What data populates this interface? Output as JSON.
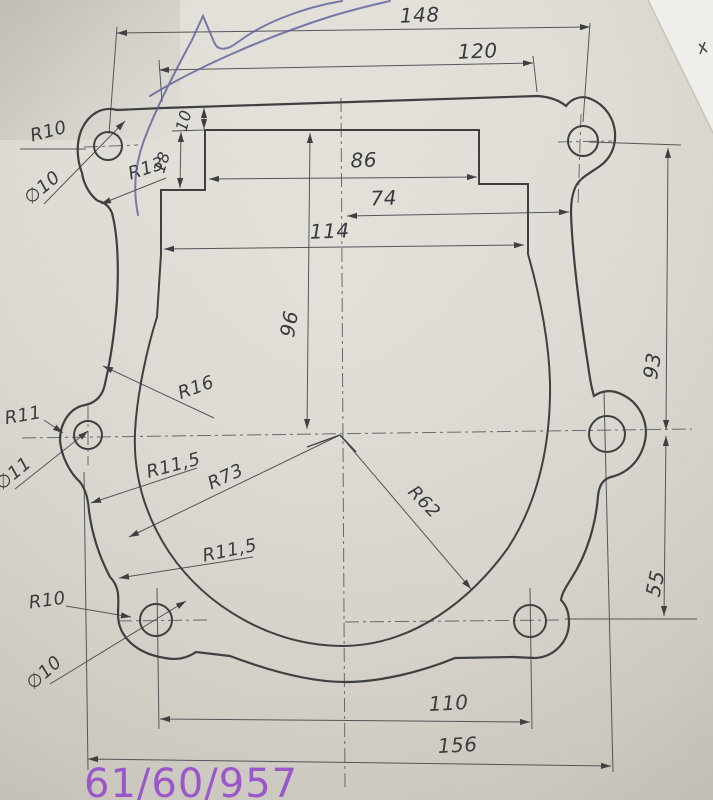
{
  "drawing": {
    "dims": {
      "top_hole_span": "148",
      "flange_width": "120",
      "step_depth_1": "10",
      "step_depth_2": "18",
      "notch_width": "86",
      "center_to_edge": "74",
      "opening_width": "114",
      "center_height": "96",
      "right_upper": "93",
      "right_lower": "55",
      "bottom_hole_span": "110",
      "bottom_width": "156"
    },
    "labels": {
      "top_lobe_radius": "R10",
      "top_hole_dia": "∅10",
      "top_fillet": "R13",
      "mid_lobe_radius": "R11",
      "mid_hole_dia": "∅11",
      "upper_fillet": "R16",
      "side_arc": "R73",
      "bottom_arc": "R62",
      "waist_upper": "R11,5",
      "waist_lower": "R11,5",
      "bottom_lobe_radius": "R10",
      "bottom_hole_dia": "∅10"
    },
    "annotation": "61/60/957"
  },
  "colors": {
    "paper": "#dfdcd5",
    "line": "#3f3f42",
    "thin_line": "#56565a",
    "pen_ink": "#5b5f9e",
    "annotation": "#9a57c9"
  }
}
